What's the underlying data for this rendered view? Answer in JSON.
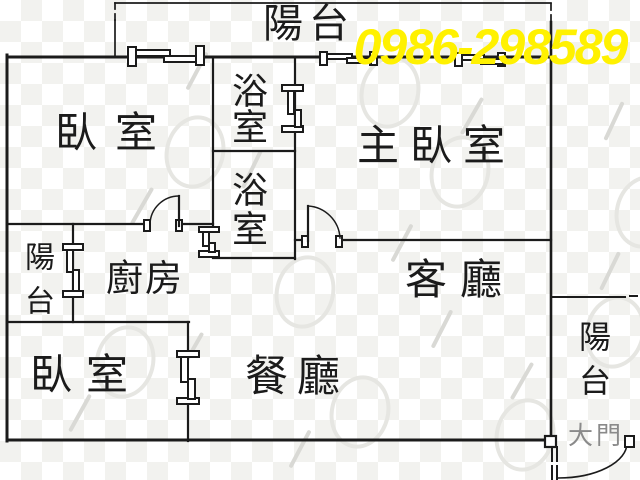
{
  "phone_number": "0986-298589",
  "labels": {
    "balcony_top": "陽台",
    "bedroom_top": "臥室",
    "bathroom_upper": "浴室",
    "bathroom_lower": "浴室",
    "master_bedroom": "主臥室",
    "balcony_left": "陽台",
    "kitchen": "廚房",
    "living_room": "客廳",
    "bedroom_bottom": "臥室",
    "dining_room": "餐廳",
    "balcony_right": "陽台",
    "main_door": "大門"
  },
  "colors": {
    "phone_fill": "#fff100",
    "phone_outline": "#000000",
    "wall_line": "#1b1b1b",
    "main_door_label": "#8a8a8a",
    "background": "#ffffff",
    "watermark_grid": "#f2f2ef"
  }
}
